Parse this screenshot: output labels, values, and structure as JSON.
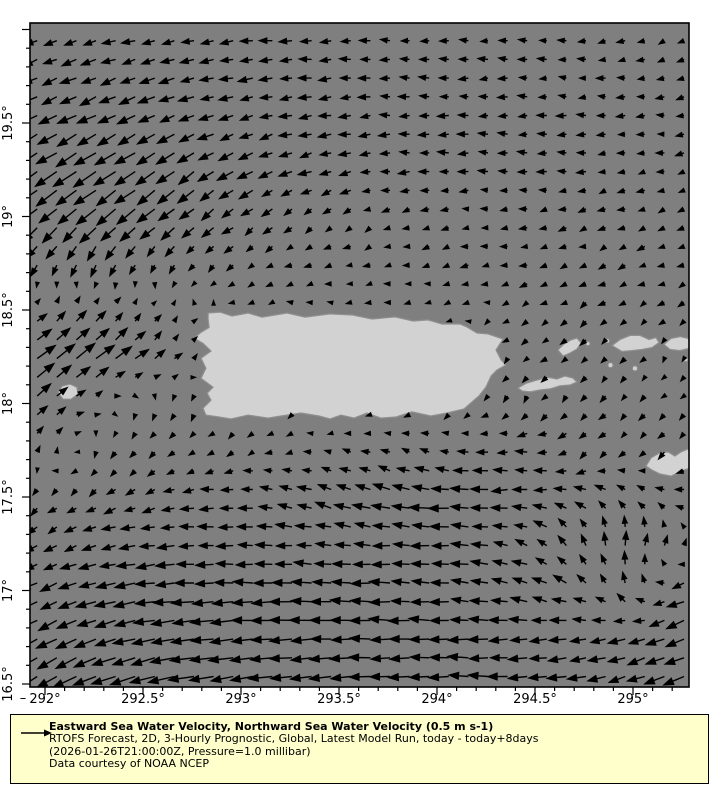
{
  "page": {
    "background": "#ffffff"
  },
  "legend": {
    "title": "Eastward Sea Water Velocity, Northward Sea Water Velocity (0.5 m s-1)",
    "line2": "RTOFS Forecast, 2D, 3-Hourly Prognostic, Global, Latest Model Run, today - today+8days",
    "line3": "(2026-01-26T21:00:00Z, Pressure=1.0 millibar)",
    "line4": "Data courtesy of NOAA NCEP",
    "background_color": "#ffffcc",
    "reference_speed": 0.5,
    "reference_speed_label": "0.5 m s-1"
  },
  "chart_data": {
    "type": "quiver",
    "title": "Eastward Sea Water Velocity, Northward Sea Water Velocity (0.5 m s-1)",
    "xlabel": "",
    "ylabel": "",
    "x_range": [
      291.92,
      295.29
    ],
    "y_range": [
      16.48,
      20.03
    ],
    "grid": false,
    "colors": {
      "ocean": "#7f7f7f",
      "land": "#d2d2d2",
      "coastline": "#8f8f8f",
      "frame": "#000000",
      "arrow": "#000000",
      "tick_label": "#000000"
    },
    "x_axis": {
      "major_values": [
        292,
        292.5,
        293,
        293.5,
        294,
        294.5,
        295
      ],
      "major_labels": [
        "292°",
        "292.5°",
        "293°",
        "293.5°",
        "294°",
        "294.5°",
        "295°"
      ],
      "minor_step": 0.1,
      "corner_dash": "–"
    },
    "y_axis": {
      "major_values": [
        16.5,
        17,
        17.5,
        18,
        18.5,
        19,
        19.5
      ],
      "major_labels": [
        "16.5°",
        "17°",
        "17.5°",
        "18°",
        "18.5°",
        "19°",
        "19.5°"
      ],
      "minor_step": 0.1,
      "minor_max": 20.0
    },
    "vector_grid": {
      "lon_start": 291.96,
      "lon_step": 0.1,
      "lon_count": 34,
      "lat_start": 16.54,
      "lat_step": 0.1,
      "lat_count": 35,
      "px_per_ms": 50,
      "jitter_ms": 0.03
    },
    "flow_field": {
      "comment_units": "u eastward m/s, v northward m/s, coarse control grid bilinearly interpolated",
      "lons": [
        292.0,
        292.25,
        292.5,
        292.75,
        293.0,
        293.25,
        293.5,
        293.75,
        294.0,
        294.25,
        294.5,
        294.75,
        295.0,
        295.25
      ],
      "lats": [
        20.0,
        19.75,
        19.5,
        19.25,
        19.0,
        18.75,
        18.5,
        18.25,
        18.0,
        17.75,
        17.5,
        17.25,
        17.0,
        16.75,
        16.5
      ],
      "u": [
        [
          -0.22,
          -0.22,
          -0.24,
          -0.25,
          -0.25,
          -0.22,
          -0.2,
          -0.18,
          -0.18,
          -0.16,
          -0.15,
          -0.15,
          -0.13,
          -0.12
        ],
        [
          -0.28,
          -0.3,
          -0.28,
          -0.27,
          -0.26,
          -0.24,
          -0.22,
          -0.2,
          -0.18,
          -0.17,
          -0.16,
          -0.15,
          -0.14,
          -0.13
        ],
        [
          -0.34,
          -0.36,
          -0.32,
          -0.29,
          -0.26,
          -0.25,
          -0.22,
          -0.2,
          -0.2,
          -0.18,
          -0.18,
          -0.16,
          -0.15,
          -0.15
        ],
        [
          -0.42,
          -0.46,
          -0.4,
          -0.32,
          -0.28,
          -0.25,
          -0.22,
          -0.2,
          -0.18,
          -0.18,
          -0.17,
          -0.16,
          -0.14,
          -0.12
        ],
        [
          -0.32,
          -0.35,
          -0.32,
          -0.26,
          -0.2,
          -0.15,
          -0.12,
          -0.12,
          -0.12,
          -0.12,
          -0.12,
          -0.12,
          -0.1,
          -0.1
        ],
        [
          -0.12,
          -0.1,
          -0.08,
          -0.08,
          -0.1,
          -0.1,
          -0.1,
          -0.1,
          -0.1,
          -0.12,
          -0.12,
          -0.12,
          -0.12,
          -0.1
        ],
        [
          0.1,
          0.12,
          0.08,
          0.02,
          -0.05,
          -0.06,
          -0.06,
          -0.06,
          -0.06,
          -0.08,
          -0.1,
          -0.12,
          -0.1,
          -0.08
        ],
        [
          0.35,
          0.35,
          0.22,
          0.08,
          0.02,
          0.0,
          0.0,
          0.0,
          0.0,
          -0.04,
          -0.08,
          -0.08,
          -0.06,
          -0.05
        ],
        [
          0.24,
          0.1,
          -0.03,
          -0.03,
          -0.02,
          -0.02,
          -0.02,
          -0.03,
          -0.05,
          -0.06,
          -0.08,
          -0.1,
          -0.08,
          -0.06
        ],
        [
          0.06,
          -0.05,
          -0.08,
          -0.08,
          -0.08,
          -0.1,
          -0.12,
          -0.14,
          -0.16,
          -0.18,
          -0.2,
          -0.12,
          -0.08,
          -0.1
        ],
        [
          -0.12,
          -0.15,
          -0.18,
          -0.24,
          -0.25,
          -0.28,
          -0.3,
          -0.34,
          -0.38,
          -0.36,
          -0.3,
          -0.22,
          -0.16,
          -0.2
        ],
        [
          -0.2,
          -0.26,
          -0.3,
          -0.3,
          -0.3,
          -0.3,
          -0.3,
          -0.34,
          -0.34,
          -0.3,
          -0.22,
          -0.08,
          0.08,
          0.06
        ],
        [
          -0.3,
          -0.35,
          -0.4,
          -0.4,
          -0.4,
          -0.4,
          -0.38,
          -0.38,
          -0.36,
          -0.34,
          -0.3,
          -0.22,
          -0.05,
          -0.28
        ],
        [
          -0.36,
          -0.4,
          -0.44,
          -0.45,
          -0.44,
          -0.42,
          -0.4,
          -0.4,
          -0.38,
          -0.36,
          -0.34,
          -0.3,
          -0.3,
          -0.34
        ],
        [
          -0.4,
          -0.45,
          -0.5,
          -0.5,
          -0.46,
          -0.45,
          -0.42,
          -0.4,
          -0.4,
          -0.38,
          -0.36,
          -0.35,
          -0.35,
          -0.4
        ]
      ],
      "v": [
        [
          -0.1,
          -0.08,
          -0.06,
          -0.05,
          -0.02,
          0,
          0,
          0,
          0.02,
          0,
          0,
          -0.02,
          -0.03,
          -0.05
        ],
        [
          -0.12,
          -0.12,
          -0.1,
          -0.08,
          -0.05,
          -0.03,
          -0.02,
          0,
          0,
          0,
          0,
          0,
          -0.02,
          -0.03
        ],
        [
          -0.18,
          -0.18,
          -0.16,
          -0.12,
          -0.08,
          -0.05,
          -0.03,
          0,
          0,
          0,
          0,
          0,
          0,
          -0.02
        ],
        [
          -0.26,
          -0.3,
          -0.27,
          -0.22,
          -0.16,
          -0.1,
          -0.06,
          -0.02,
          0,
          0,
          0,
          -0.02,
          -0.03,
          -0.04
        ],
        [
          -0.28,
          -0.3,
          -0.28,
          -0.22,
          -0.15,
          -0.1,
          -0.08,
          -0.05,
          -0.03,
          -0.02,
          -0.03,
          -0.04,
          -0.04,
          -0.04
        ],
        [
          -0.2,
          -0.22,
          -0.18,
          -0.12,
          -0.08,
          -0.05,
          -0.05,
          -0.03,
          -0.03,
          -0.02,
          -0.03,
          -0.04,
          -0.05,
          -0.05
        ],
        [
          0.12,
          0.15,
          0.1,
          0.04,
          0,
          0,
          0,
          0,
          0,
          -0.02,
          -0.05,
          -0.08,
          -0.08,
          -0.05
        ],
        [
          0.28,
          0.3,
          0.2,
          0.08,
          0.02,
          0,
          0,
          0,
          0,
          -0.04,
          -0.08,
          -0.08,
          -0.06,
          -0.05
        ],
        [
          0.2,
          0.05,
          -0.1,
          -0.1,
          -0.08,
          -0.05,
          -0.05,
          -0.06,
          -0.08,
          -0.1,
          -0.1,
          -0.1,
          -0.08,
          -0.05
        ],
        [
          0.1,
          -0.08,
          -0.1,
          -0.08,
          -0.05,
          -0.02,
          0.02,
          0.04,
          0.04,
          0.02,
          0.0,
          -0.1,
          -0.1,
          -0.12
        ],
        [
          -0.12,
          -0.1,
          -0.08,
          -0.02,
          0.02,
          0.06,
          0.12,
          0.1,
          0.04,
          -0.02,
          0.0,
          0.05,
          0.12,
          0.04
        ],
        [
          -0.1,
          -0.08,
          -0.05,
          -0.02,
          0,
          0.02,
          0.04,
          0.02,
          0,
          0.04,
          0.1,
          0.22,
          0.28,
          0.1
        ],
        [
          -0.15,
          -0.1,
          -0.06,
          -0.02,
          0,
          0,
          0,
          0.02,
          0.02,
          0.04,
          0.08,
          0.14,
          0.2,
          -0.12
        ],
        [
          -0.2,
          -0.16,
          -0.1,
          -0.06,
          -0.05,
          -0.02,
          0,
          0,
          0,
          0,
          -0.02,
          -0.05,
          -0.1,
          -0.15
        ],
        [
          -0.25,
          -0.2,
          -0.15,
          -0.1,
          -0.06,
          -0.05,
          -0.02,
          -0.02,
          0,
          0,
          -0.02,
          -0.05,
          -0.1,
          -0.15
        ]
      ]
    },
    "islands": [
      {
        "name": "puerto-rico",
        "points": [
          292.832,
          18.484,
          292.893,
          18.489,
          292.954,
          18.468,
          293.036,
          18.484,
          293.107,
          18.462,
          293.235,
          18.484,
          293.327,
          18.462,
          293.454,
          18.479,
          293.571,
          18.473,
          293.668,
          18.452,
          293.786,
          18.463,
          293.878,
          18.441,
          293.954,
          18.447,
          294.026,
          18.425,
          294.117,
          18.425,
          294.153,
          18.409,
          294.204,
          18.377,
          294.26,
          18.372,
          294.337,
          18.345,
          294.301,
          18.286,
          294.327,
          18.233,
          294.352,
          18.206,
          294.306,
          18.179,
          294.276,
          18.147,
          294.25,
          18.088,
          294.214,
          18.04,
          294.138,
          17.971,
          294.051,
          17.949,
          293.969,
          17.933,
          293.872,
          17.955,
          293.791,
          17.928,
          293.714,
          17.922,
          293.643,
          17.949,
          293.577,
          17.922,
          293.51,
          17.938,
          293.454,
          17.917,
          293.398,
          17.933,
          293.306,
          17.949,
          293.204,
          17.933,
          293.138,
          17.922,
          293.036,
          17.938,
          292.949,
          17.917,
          292.888,
          17.928,
          292.821,
          17.938,
          292.806,
          17.975,
          292.847,
          18.018,
          292.827,
          18.055,
          292.857,
          18.087,
          292.796,
          18.135,
          292.821,
          18.189,
          292.796,
          18.242,
          292.847,
          18.28,
          292.806,
          18.322,
          292.76,
          18.349,
          292.796,
          18.381,
          292.837,
          18.407,
          292.832,
          18.45
        ]
      },
      {
        "name": "vieques",
        "points": [
          294.413,
          18.083,
          294.454,
          18.108,
          294.505,
          18.124,
          294.566,
          18.14,
          294.612,
          18.131,
          294.653,
          18.147,
          294.694,
          18.136,
          294.714,
          18.115,
          294.679,
          18.099,
          294.628,
          18.094,
          294.577,
          18.078,
          294.526,
          18.072,
          294.475,
          18.062,
          294.434,
          18.067
        ]
      },
      {
        "name": "culebra",
        "points": [
          294.617,
          18.286,
          294.648,
          18.318,
          294.684,
          18.34,
          294.714,
          18.35,
          294.735,
          18.324,
          294.714,
          18.291,
          294.679,
          18.27,
          294.643,
          18.254
        ]
      },
      {
        "name": "st-thomas",
        "points": [
          294.893,
          18.31,
          294.934,
          18.342,
          294.985,
          18.364,
          295.036,
          18.364,
          295.082,
          18.342,
          295.117,
          18.353,
          295.133,
          18.326,
          295.097,
          18.299,
          295.046,
          18.289,
          294.995,
          18.283,
          294.944,
          18.278
        ]
      },
      {
        "name": "st-john",
        "points": [
          295.158,
          18.316,
          295.194,
          18.348,
          295.24,
          18.358,
          295.281,
          18.348,
          295.296,
          18.326,
          295.286,
          18.294,
          295.24,
          18.283,
          295.189,
          18.289
        ]
      },
      {
        "name": "st-croix",
        "points": [
          295.066,
          17.666,
          295.092,
          17.709,
          295.133,
          17.735,
          295.179,
          17.741,
          295.214,
          17.719,
          295.245,
          17.741,
          295.281,
          17.757,
          295.296,
          17.725,
          295.291,
          17.655,
          295.245,
          17.639,
          295.194,
          17.612,
          295.138,
          17.623,
          295.097,
          17.644
        ]
      },
      {
        "name": "mona",
        "points": [
          292.066,
          18.061,
          292.087,
          18.093,
          292.128,
          18.104,
          292.163,
          18.087,
          292.168,
          18.05,
          292.133,
          18.023,
          292.092,
          18.023
        ]
      }
    ],
    "islets": [
      [
        294.77,
        18.32,
        2
      ],
      [
        294.87,
        18.335,
        2
      ],
      [
        294.885,
        18.205,
        2.5
      ],
      [
        295.01,
        18.188,
        2.5
      ],
      [
        295.27,
        18.235,
        2
      ]
    ]
  }
}
